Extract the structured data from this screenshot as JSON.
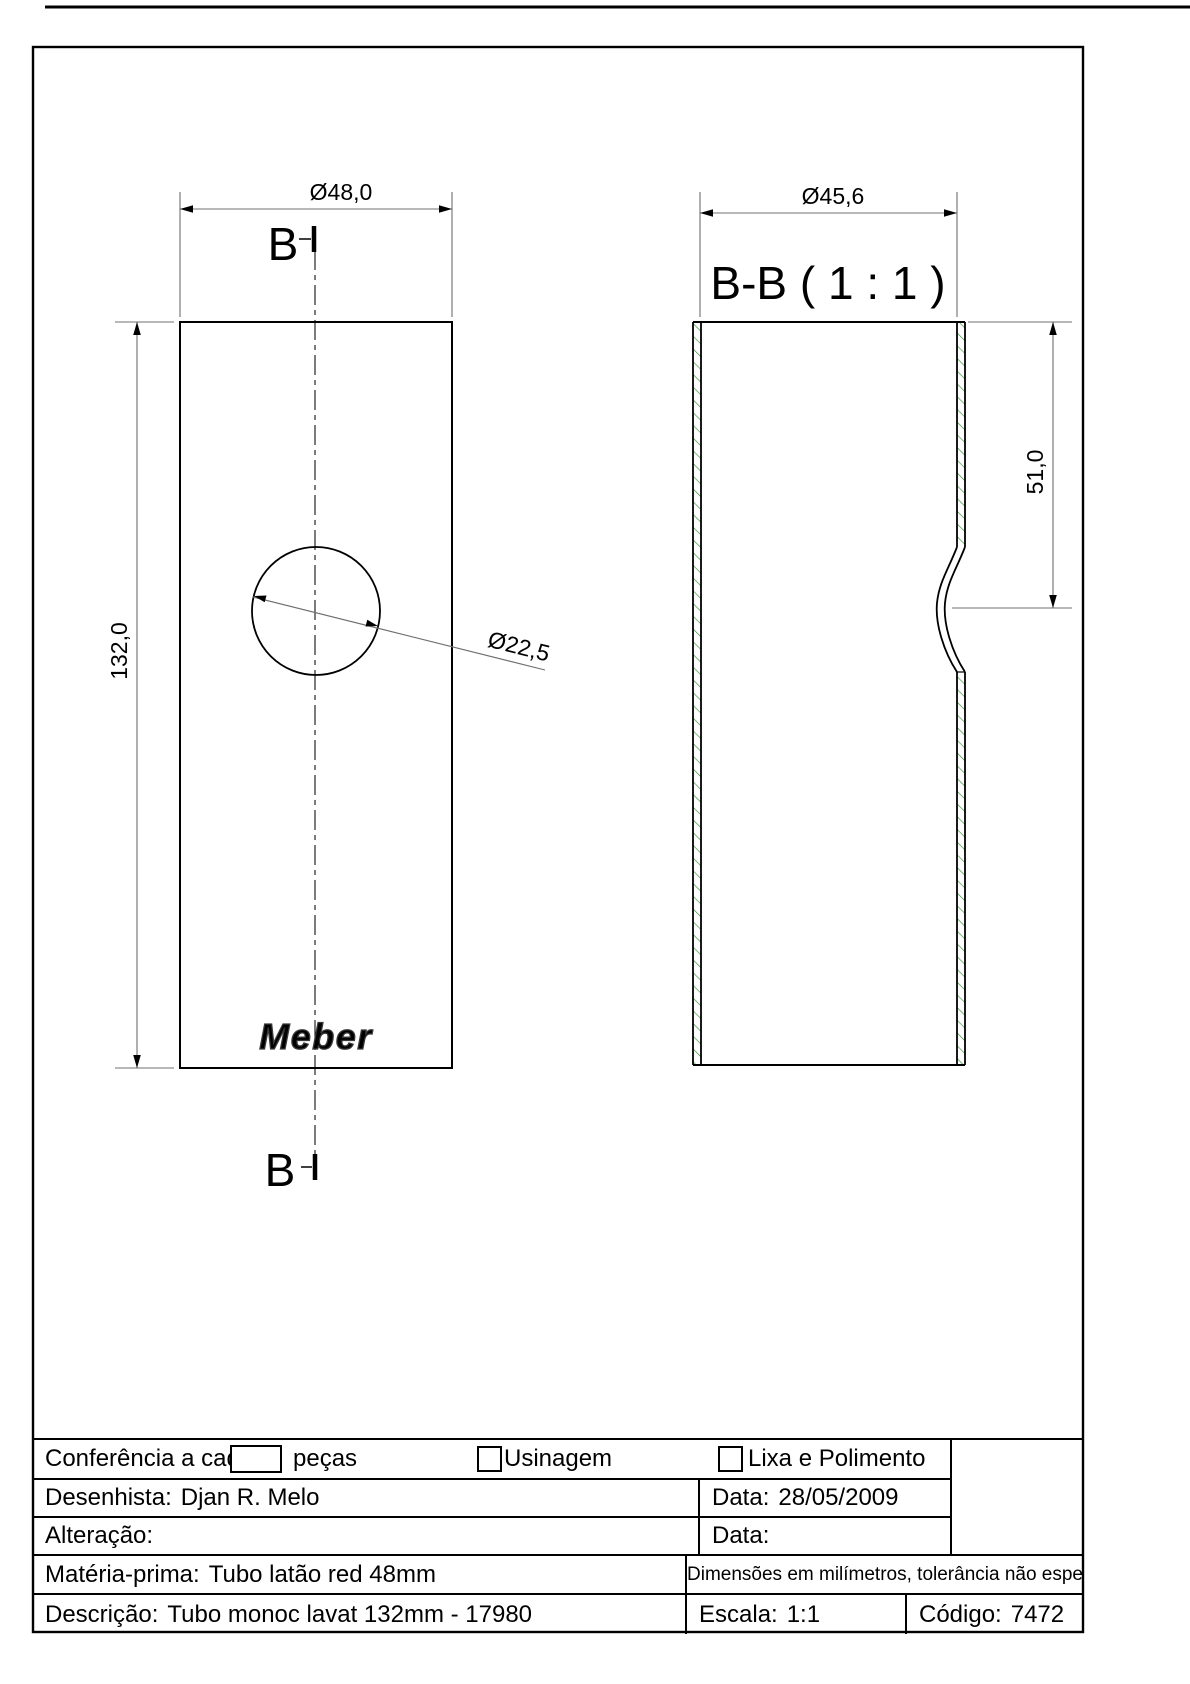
{
  "drawing": {
    "front_view": {
      "section_marker": "B",
      "width_dim": "Ø48,0",
      "height_dim": "132,0",
      "hole_dim": "Ø22,5",
      "logo": "Meber"
    },
    "section_view": {
      "title": "B-B ( 1 : 1 )",
      "inner_width_dim": "Ø45,6",
      "neck_dim": "51,0"
    },
    "hatch_color": "#3f8c3f",
    "line_color": "#000000",
    "dim_line_color": "#707070"
  },
  "title_block": {
    "row1": {
      "conferencia_label": "Conferência a cada",
      "pecas_label": "peças",
      "usinagem_label": "Usinagem",
      "lixa_label": "Lixa e Polimento"
    },
    "row2": {
      "desenhista_label": "Desenhista:",
      "desenhista_value": "Djan R. Melo",
      "data_label": "Data:",
      "data_value": "28/05/2009"
    },
    "row3": {
      "alteracao_label": "Alteração:",
      "data_label": "Data:",
      "data_value": ""
    },
    "row4": {
      "materia_label": "Matéria-prima:",
      "materia_value": "Tubo latão red 48mm",
      "tolerance_note": "Dimensões em milímetros, tolerância não especificada ± 0,1"
    },
    "row5": {
      "descricao_label": "Descrição:",
      "descricao_value": "Tubo monoc lavat 132mm - 17980",
      "escala_label": "Escala:",
      "escala_value": "1:1",
      "codigo_label": "Código:",
      "codigo_value": "7472"
    }
  }
}
